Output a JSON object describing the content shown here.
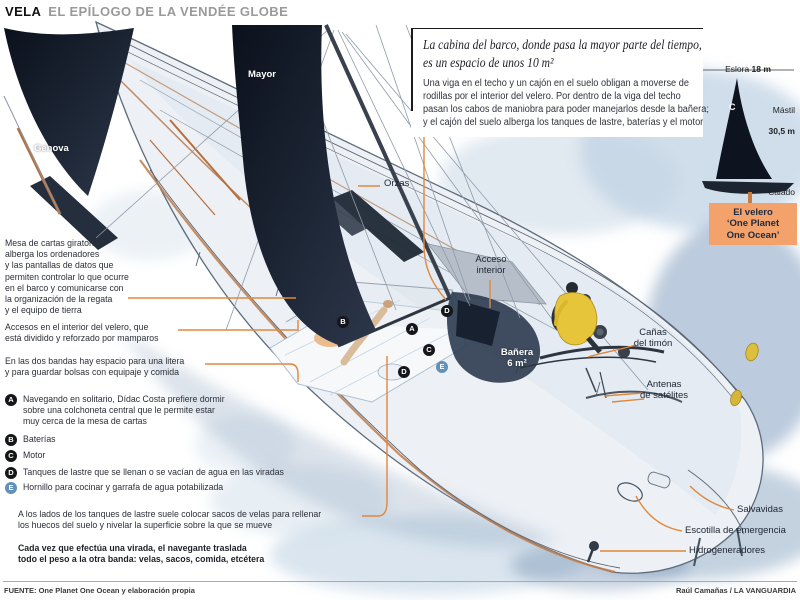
{
  "header": {
    "kicker": "VELA",
    "title": "EL EPÍLOGO DE LA VENDÉE GLOBE"
  },
  "intro": {
    "title": "La cabina del barco, donde pasa la mayor parte del tiempo,\nes un espacio de unos 10 m²",
    "body": "Una viga en el techo y un cajón en el suelo obligan a moverse de\nrodillas por el interior del velero. Por dentro de la viga del techo\npasan los cabos de maniobra para poder manejarlos desde la bañera;\ny el cajón del suelo alberga los tanques de lastre, baterías y el motor"
  },
  "side": {
    "eslora_label": "Eslora",
    "eslora_value": "18 m",
    "mastil_label": "Mástil",
    "mastil_value": "30,5 m",
    "calado_label": "Calado",
    "calado_value": "4,5 m",
    "sail_logo": "C",
    "boat_box": "El velero\n‘One Planet\nOne Ocean’"
  },
  "notes": {
    "mesa": "Mesa de cartas giratoria,\nalberga los ordenadores\ny las pantallas de datos que\npermiten controlar lo que ocurre\nen el barco y comunicarse con\nla organización de la regata\ny el equipo de tierra",
    "accesos": "Accesos en el interior del velero, que\nestá dividido y reforzado por mamparos",
    "bandas": "En las dos bandas hay espacio para una litera\ny para guardar bolsas con equipaje y comida",
    "sacos": "A los lados de los tanques de lastre suele colocar sacos de velas para rellenar\nlos huecos del suelo y nivelar la superficie sobre la que se mueve",
    "virada": "Cada vez que efectúa una virada, el navegante traslada\ntodo el peso a la otra banda: velas, sacos, comida, etcétera"
  },
  "legend": [
    {
      "letter": "A",
      "text": "Navegando en solitario, Dídac Costa prefiere dormir\nsobre una colchoneta central que le permite estar\nmuy cerca de la mesa de cartas"
    },
    {
      "letter": "B",
      "text": "Baterías"
    },
    {
      "letter": "C",
      "text": "Motor"
    },
    {
      "letter": "D",
      "text": "Tanques de lastre que se llenan o se vacían de agua en las viradas"
    },
    {
      "letter": "E",
      "text": "Hornillo para cocinar y garrafa de agua potabilizada"
    }
  ],
  "deck_markers": [
    "B",
    "A",
    "D",
    "C",
    "D",
    "E"
  ],
  "boat_labels": {
    "mayor": "Mayor",
    "genova": "Génova",
    "orzas": "Orzas",
    "acceso": "Acceso\ninterior",
    "banera": "Bañera\n6 m²",
    "canas": "Cañas\ndel timón",
    "antenas": "Antenas\nde satélites",
    "salvavidas": "Salvavidas",
    "escotilla": "Escotilla de emergencia",
    "hidrogeneradores": "Hidrogeneradores"
  },
  "footer": {
    "source": "FUENTE: One Planet One Ocean y elaboración propia",
    "credit": "Raúl Camañas / LA VANGUARDIA"
  },
  "colors": {
    "accent_orange": "#e0873c",
    "box_orange": "#f3a26b",
    "marker_black": "#15161a",
    "marker_blue": "#6191bb",
    "sail_dark": "#0d1420"
  }
}
